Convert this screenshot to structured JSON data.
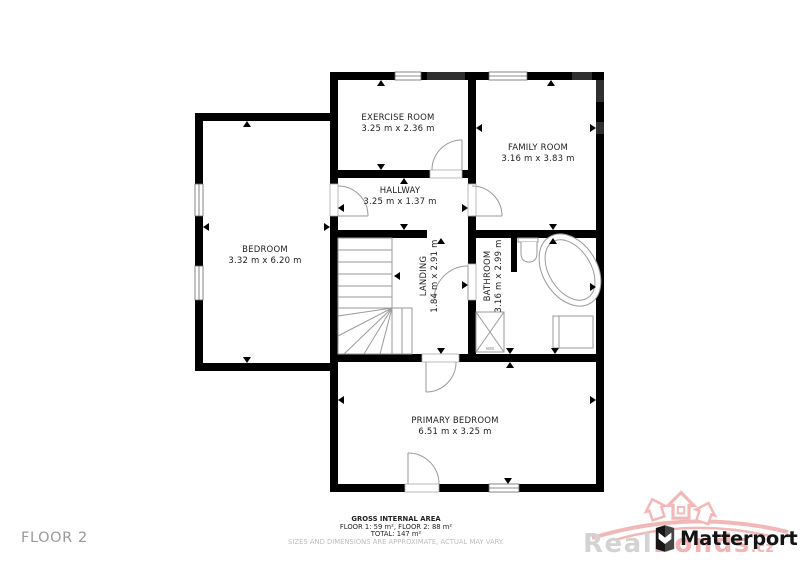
{
  "floor_label": "FLOOR 2",
  "rooms": {
    "exercise": {
      "name": "EXERCISE ROOM",
      "dims": "3.25 m x 2.36 m"
    },
    "family": {
      "name": "FAMILY ROOM",
      "dims": "3.16 m x 3.83 m"
    },
    "hallway": {
      "name": "HALLWAY",
      "dims": "3.25 m x 1.37 m"
    },
    "bedroom": {
      "name": "BEDROOM",
      "dims": "3.32 m x 6.20 m"
    },
    "landing": {
      "name": "LANDING",
      "dims": "1.84 m x 2.91 m"
    },
    "bathroom": {
      "name": "BATHROOM",
      "dims": "3.16 m x 2.99 m"
    },
    "primary": {
      "name": "PRIMARY BEDROOM",
      "dims": "6.51 m x 3.25 m"
    }
  },
  "footer": {
    "title": "GROSS INTERNAL AREA",
    "areas": "FLOOR 1: 59 m², FLOOR 2: 88 m²",
    "total": "TOTAL: 147 m²",
    "disclaimer": "SIZES AND DIMENSIONS ARE APPROXIMATE, ACTUAL MAY VARY."
  },
  "branding": {
    "matterport": "Matterport",
    "watermark_real": "Real",
    "watermark_bonds": "Bonds",
    "watermark_tld": ".cz"
  },
  "colors": {
    "wall": "#000000",
    "wall_gray_segment": "#2f2f2f",
    "plan_lines": "#9a9a9a",
    "muted_text": "#9a9a9a",
    "watermark_pink": "#f2b4b4",
    "watermark_gray": "#d3d3d3"
  }
}
